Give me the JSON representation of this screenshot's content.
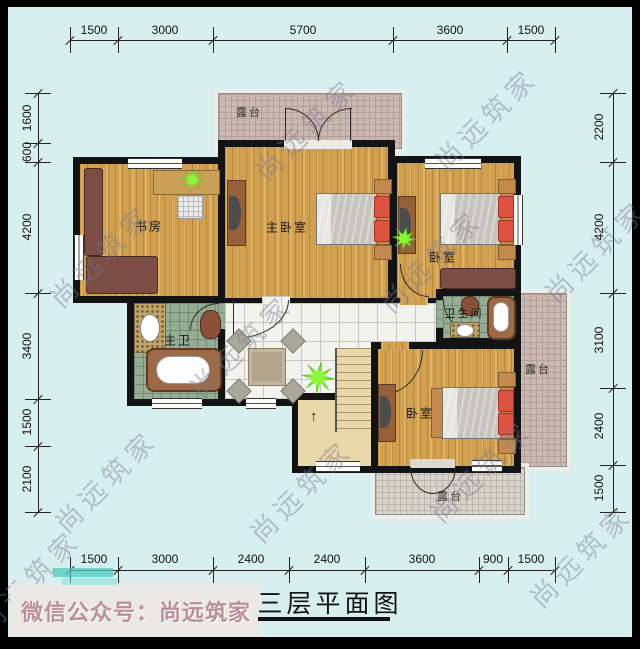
{
  "title": {
    "text": "三层平面图"
  },
  "footer": {
    "wechat_label": "微信公众号：尚远筑家"
  },
  "watermark": {
    "text": "尚远筑家"
  },
  "rooms": {
    "study": {
      "label": "书房"
    },
    "master_bedroom": {
      "label": "主卧室"
    },
    "bedroom_right": {
      "label": "卧室"
    },
    "bedroom_bottom": {
      "label": "卧室"
    },
    "master_bath": {
      "label": "主卫"
    },
    "bathroom": {
      "label": "卫生间"
    },
    "terrace_top": {
      "label": "露台"
    },
    "terrace_right": {
      "label": "露台"
    },
    "terrace_bottom": {
      "label": "露台"
    }
  },
  "dimensions": {
    "top": [
      "1500",
      "3000",
      "5700",
      "3600",
      "1500"
    ],
    "bottom": [
      "1500",
      "3000",
      "2400",
      "2400",
      "3600",
      "900",
      "1500"
    ],
    "left": [
      "1600",
      "600",
      "4200",
      "3400",
      "1500",
      "2100"
    ],
    "right": [
      "2200",
      "4200",
      "3100",
      "2400",
      "1500"
    ]
  },
  "colors": {
    "background": "#d7f0ef",
    "wall": "#131313",
    "wood_floor": "#d1a050",
    "green_tile": "#95ad94",
    "white_tile": "#f3f3ee",
    "terrace_tile": "#ccb9b2",
    "stair": "#e9d8aa",
    "plant": "#2fb31a",
    "pillow": "#dd5240",
    "watermark": "#7a7691",
    "wechat_text": "#bd8f97"
  }
}
